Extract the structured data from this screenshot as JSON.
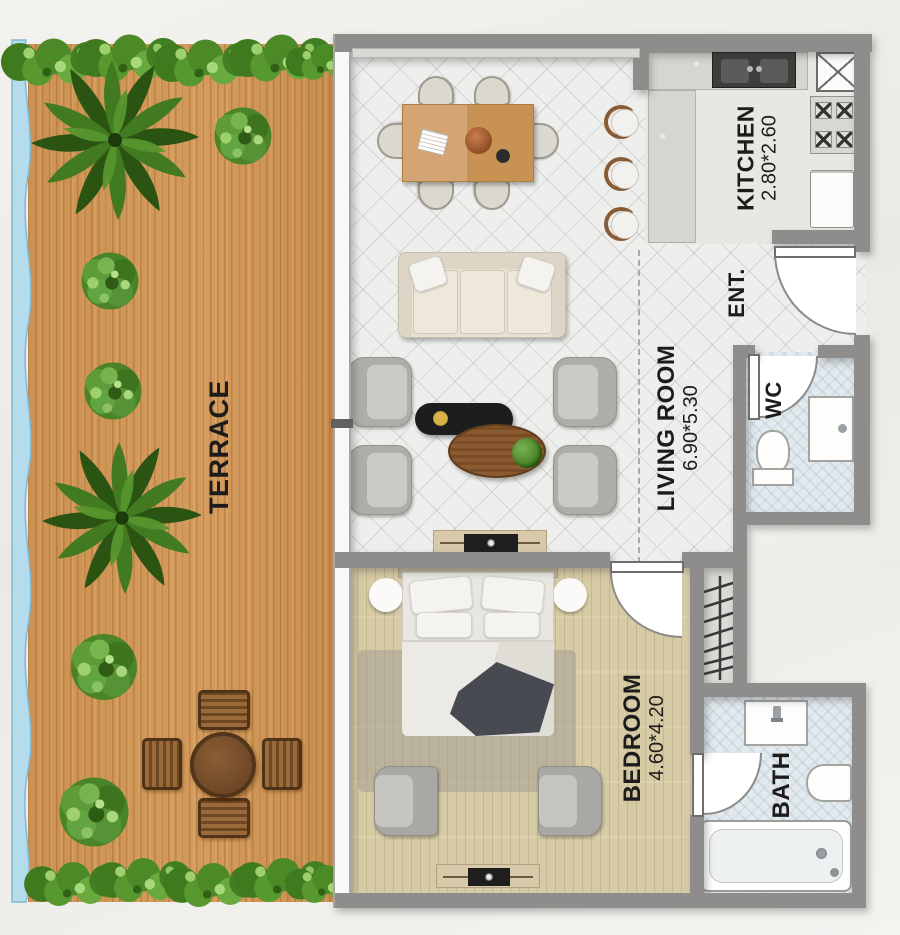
{
  "plan": {
    "terrace": {
      "label": "TERRACE"
    },
    "kitchen": {
      "label": "KITCHEN",
      "dims": "2.80*2.60"
    },
    "living_room": {
      "label": "LIVING ROOM",
      "dims": "6.90*5.30"
    },
    "entrance": {
      "label": "ENT."
    },
    "wc": {
      "label": "WC"
    },
    "bedroom": {
      "label": "BEDROOM",
      "dims": "4.60*4.20"
    },
    "bath": {
      "label": "BATH"
    }
  },
  "colors": {
    "wall": "#8e8d8b",
    "deck": "#cd9251",
    "hedge_green": "#4c8a28",
    "living_floor": "#eeeeec",
    "bedroom_floor": "#d7cba6",
    "wet_floor": "#e3eaee",
    "water_edge": "#b5dcec"
  }
}
